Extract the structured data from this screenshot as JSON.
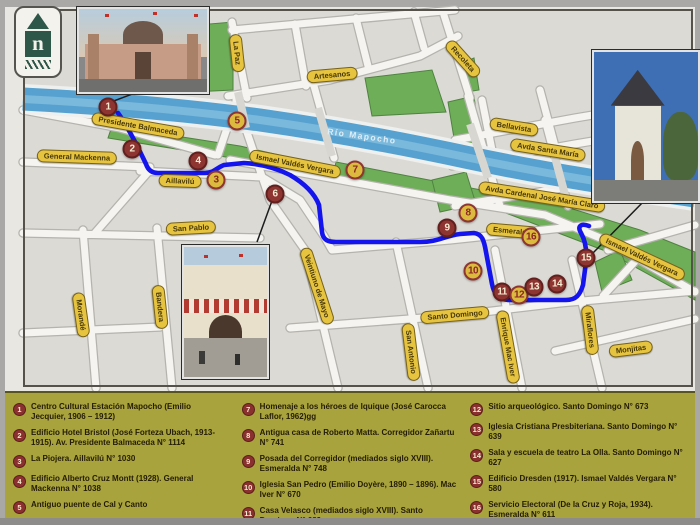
{
  "colors": {
    "legend_bg": "#a8a33c",
    "marker_red": "#8e3532",
    "marker_yellow": "#dcba3e",
    "route_blue": "#1414ee",
    "river_blue": "#56a1cf",
    "park_green": "#6fae58",
    "street_label_bg": "#e6c440",
    "paper": "#e9e7e1"
  },
  "logo": {
    "letter": "n"
  },
  "map": {
    "river_label": "Río Mapocho",
    "streets": [
      {
        "name": "Presidente Balmaceda"
      },
      {
        "name": "General Mackenna"
      },
      {
        "name": "Aillavilú"
      },
      {
        "name": "La Paz"
      },
      {
        "name": "Artesanos"
      },
      {
        "name": "Ismael Valdés Vergara"
      },
      {
        "name": "Recoleta"
      },
      {
        "name": "Bellavista"
      },
      {
        "name": "Avda  Santa María"
      },
      {
        "name": "Avda  Cardenal José María Claro"
      },
      {
        "name": "Esmeralda"
      },
      {
        "name": "San Pablo"
      },
      {
        "name": "Morandé"
      },
      {
        "name": "Bandera"
      },
      {
        "name": "Veintiuno de Mayo"
      },
      {
        "name": "San Antonio"
      },
      {
        "name": "Santo Domingo"
      },
      {
        "name": "Enrique Mac Iver"
      },
      {
        "name": "Miraflores"
      },
      {
        "name": "Monjitas"
      },
      {
        "name": "Ismael Valdés Vergara"
      }
    ],
    "markers": [
      {
        "n": "1",
        "type": "red"
      },
      {
        "n": "2",
        "type": "red"
      },
      {
        "n": "3",
        "type": "yellow"
      },
      {
        "n": "4",
        "type": "red"
      },
      {
        "n": "5",
        "type": "yellow"
      },
      {
        "n": "6",
        "type": "red"
      },
      {
        "n": "7",
        "type": "yellow"
      },
      {
        "n": "8",
        "type": "yellow"
      },
      {
        "n": "9",
        "type": "red"
      },
      {
        "n": "10",
        "type": "yellow"
      },
      {
        "n": "11",
        "type": "red"
      },
      {
        "n": "12",
        "type": "yellow"
      },
      {
        "n": "13",
        "type": "red"
      },
      {
        "n": "14",
        "type": "red"
      },
      {
        "n": "15",
        "type": "red"
      },
      {
        "n": "16",
        "type": "yellow"
      }
    ]
  },
  "legend": {
    "items": [
      {
        "num": "1",
        "text": "Centro Cultural Estación Mapocho (Emilio Jecquier, 1906 – 1912)"
      },
      {
        "num": "2",
        "text": "Edificio Hotel Bristol (José Forteza Ubach, 1913- 1915). Av. Presidente Balmaceda N° 1114"
      },
      {
        "num": "3",
        "text": "La Piojera. Aillavilú N° 1030"
      },
      {
        "num": "4",
        "text": "Edificio Alberto Cruz Montt (1928). General Mackenna N° 1038"
      },
      {
        "num": "5",
        "text": "Antiguo puente de Cal y Canto"
      },
      {
        "num": "6",
        "text": "Mercado Central (M. Aldunate, F. Vivaceta, 1868 – 1872)"
      },
      {
        "num": "7",
        "text": "Homenaje a los héroes de Iquique (José Carocca Laflor, 1962)gg"
      },
      {
        "num": "8",
        "text": "Antigua casa de Roberto Matta. Corregidor Zañartu N° 741"
      },
      {
        "num": "9",
        "text": "Posada del Corregidor (mediados siglo XVIII). Esmeralda N° 748"
      },
      {
        "num": "10",
        "text": "Iglesia San Pedro (Emilio Doyère, 1890 – 1896). Mac Iver N° 670"
      },
      {
        "num": "11",
        "text": "Casa Velasco (mediados siglo XVIII). Santo Domingo N° 689"
      },
      {
        "num": "12",
        "text": "Sitio arqueológico. Santo Domingo N° 673"
      },
      {
        "num": "13",
        "text": "Iglesia Cristiana Presbiteriana. Santo Domingo N° 639"
      },
      {
        "num": "14",
        "text": "Sala y escuela de teatro La Olla. Santo Domingo N° 627"
      },
      {
        "num": "15",
        "text": "Edificio Dresden (1917). Ismael Valdés Vergara N° 580"
      },
      {
        "num": "16",
        "text": "Servicio Electoral (De la Cruz y Roja, 1934). Esmeralda N° 611"
      }
    ]
  }
}
